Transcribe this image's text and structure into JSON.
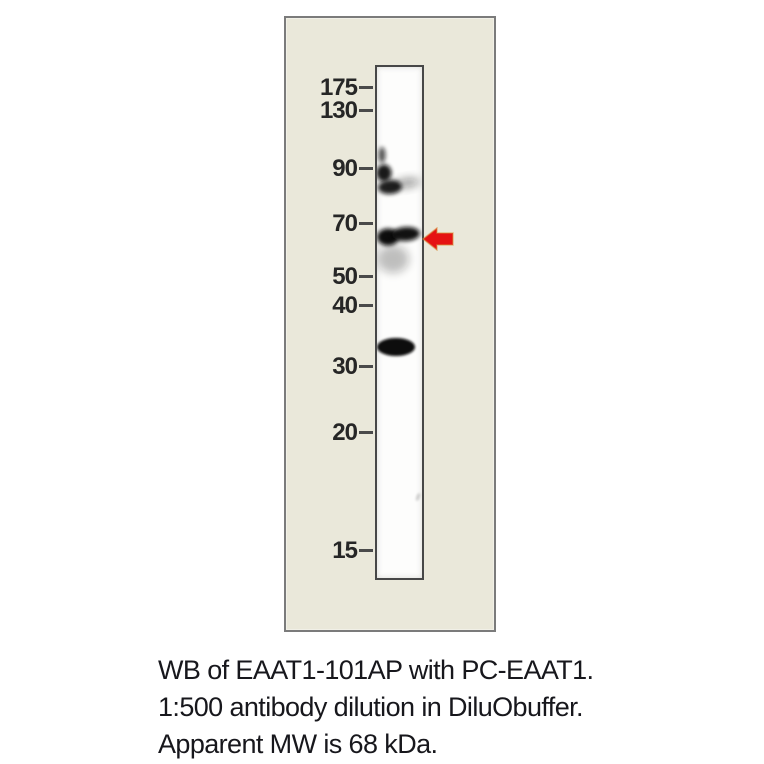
{
  "figure": {
    "kind": "western-blot",
    "panel_background": "#eae8da",
    "panel_border_color": "#7b7b7b",
    "lane_border_color": "#474747",
    "lane_background": "#fdfdfc"
  },
  "markers": {
    "unit": "kDa",
    "label_color": "#262626",
    "tick_color": "#4a4a4a",
    "items": [
      {
        "label": "175",
        "y": 70
      },
      {
        "label": "130",
        "y": 93
      },
      {
        "label": "90",
        "y": 151
      },
      {
        "label": "70",
        "y": 206
      },
      {
        "label": "50",
        "y": 259
      },
      {
        "label": "40",
        "y": 288
      },
      {
        "label": "30",
        "y": 349
      },
      {
        "label": "20",
        "y": 415
      },
      {
        "label": "15",
        "y": 533
      }
    ]
  },
  "bands": {
    "color": "#0a0a0a",
    "items": [
      {
        "name": "band-90-streak",
        "approx_kda": 92,
        "cx": 5,
        "cy": 88,
        "rx": 3.5,
        "ry": 8,
        "opacity": 0.7,
        "blur": "f2",
        "rotate": 0
      },
      {
        "name": "band-90-blob",
        "approx_kda": 88,
        "cx": 7,
        "cy": 106,
        "rx": 7.5,
        "ry": 8.5,
        "opacity": 0.95,
        "blur": "f2",
        "rotate": 0
      },
      {
        "name": "band-84-core",
        "approx_kda": 84,
        "cx": 13,
        "cy": 120,
        "rx": 12,
        "ry": 7,
        "opacity": 0.92,
        "blur": "f2",
        "rotate": -4
      },
      {
        "name": "band-84-tail",
        "approx_kda": 84,
        "cx": 30,
        "cy": 116,
        "rx": 13,
        "ry": 4.5,
        "opacity": 0.42,
        "blur": "f3",
        "rotate": -8
      },
      {
        "name": "band-68-left",
        "approx_kda": 68,
        "cx": 11,
        "cy": 170,
        "rx": 11,
        "ry": 8.5,
        "opacity": 1,
        "blur": "f2",
        "rotate": 0
      },
      {
        "name": "band-68-right",
        "approx_kda": 68,
        "cx": 29,
        "cy": 167,
        "rx": 14,
        "ry": 7,
        "opacity": 0.98,
        "blur": "f2",
        "rotate": -3
      },
      {
        "name": "band-68-haze",
        "approx_kda": 62,
        "cx": 16,
        "cy": 192,
        "rx": 16,
        "ry": 14,
        "opacity": 0.26,
        "blur": "f3",
        "rotate": 0
      },
      {
        "name": "band-33",
        "approx_kda": 33,
        "cx": 19,
        "cy": 280,
        "rx": 19,
        "ry": 9,
        "opacity": 1,
        "blur": "f1",
        "rotate": 0
      },
      {
        "name": "speck",
        "approx_kda": 17,
        "cx": 41,
        "cy": 430,
        "rx": 1.5,
        "ry": 4,
        "opacity": 0.22,
        "blur": "f1",
        "rotate": 20
      }
    ]
  },
  "arrow": {
    "color": "#e51212",
    "halo_color": "#d98f3e",
    "points": "1,12 15,1 15,6 31,6 31,18 15,18 15,23",
    "points_to_kda": 68
  },
  "caption": {
    "color": "#17171c",
    "lines": [
      "WB of EAAT1-101AP with PC-EAAT1.",
      "1:500 antibody dilution in DiluObuffer.",
      "Apparent MW is 68 kDa."
    ]
  }
}
